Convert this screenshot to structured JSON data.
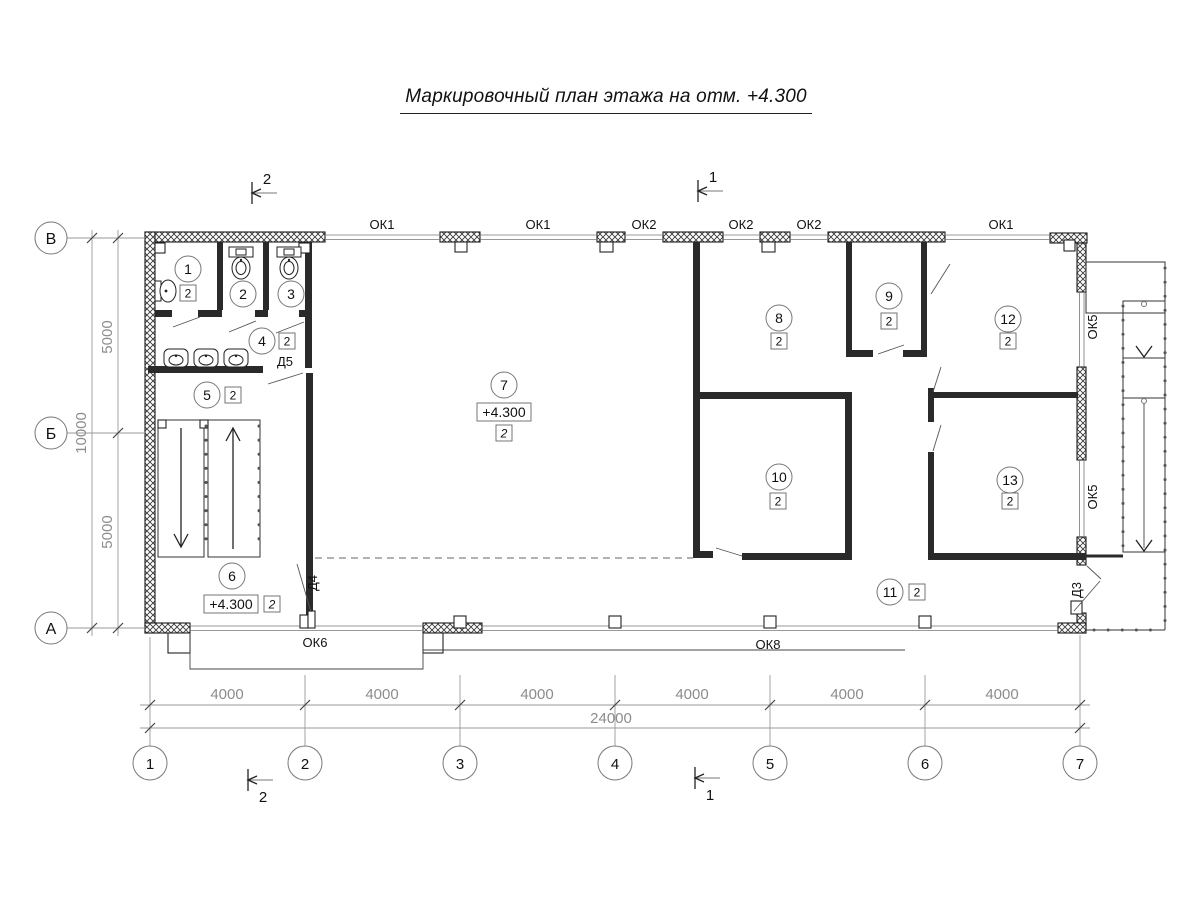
{
  "title": "Маркировочный план этажа на отм. +4.300",
  "grid": {
    "rows": [
      {
        "label": "В"
      },
      {
        "label": "Б"
      },
      {
        "label": "А"
      }
    ],
    "cols": [
      {
        "label": "1"
      },
      {
        "label": "2"
      },
      {
        "label": "3"
      },
      {
        "label": "4"
      },
      {
        "label": "5"
      },
      {
        "label": "6"
      },
      {
        "label": "7"
      }
    ]
  },
  "dims": {
    "left_top": "5000",
    "left_bottom": "5000",
    "left_total": "10000",
    "bottom": [
      {
        "v": "4000"
      },
      {
        "v": "4000"
      },
      {
        "v": "4000"
      },
      {
        "v": "4000"
      },
      {
        "v": "4000"
      },
      {
        "v": "4000"
      }
    ],
    "bottom_total": "24000"
  },
  "sections": {
    "cut1": "1",
    "cut2": "2"
  },
  "windows": [
    {
      "label": "ОК1"
    },
    {
      "label": "ОК1"
    },
    {
      "label": "ОК2"
    },
    {
      "label": "ОК2"
    },
    {
      "label": "ОК2"
    },
    {
      "label": "ОК1"
    },
    {
      "label": "ОК5"
    },
    {
      "label": "ОК5"
    },
    {
      "label": "ОК6"
    },
    {
      "label": "ОК8"
    }
  ],
  "doors": [
    {
      "label": "Д5"
    },
    {
      "label": "Д4"
    },
    {
      "label": "Д3"
    }
  ],
  "rooms": [
    {
      "number": "1",
      "category": "2"
    },
    {
      "number": "2"
    },
    {
      "number": "3"
    },
    {
      "number": "4",
      "category": "2"
    },
    {
      "number": "5",
      "category": "2"
    },
    {
      "number": "6",
      "category": "2",
      "elevation": "+4.300"
    },
    {
      "number": "7",
      "category": "2",
      "elevation": "+4.300"
    },
    {
      "number": "8",
      "category": "2"
    },
    {
      "number": "9",
      "category": "2"
    },
    {
      "number": "10",
      "category": "2"
    },
    {
      "number": "11",
      "category": "2"
    },
    {
      "number": "12",
      "category": "2"
    },
    {
      "number": "13",
      "category": "2"
    }
  ],
  "colors": {
    "wall_line": "#1a1a1a",
    "dim_text": "#8c8c8c"
  }
}
